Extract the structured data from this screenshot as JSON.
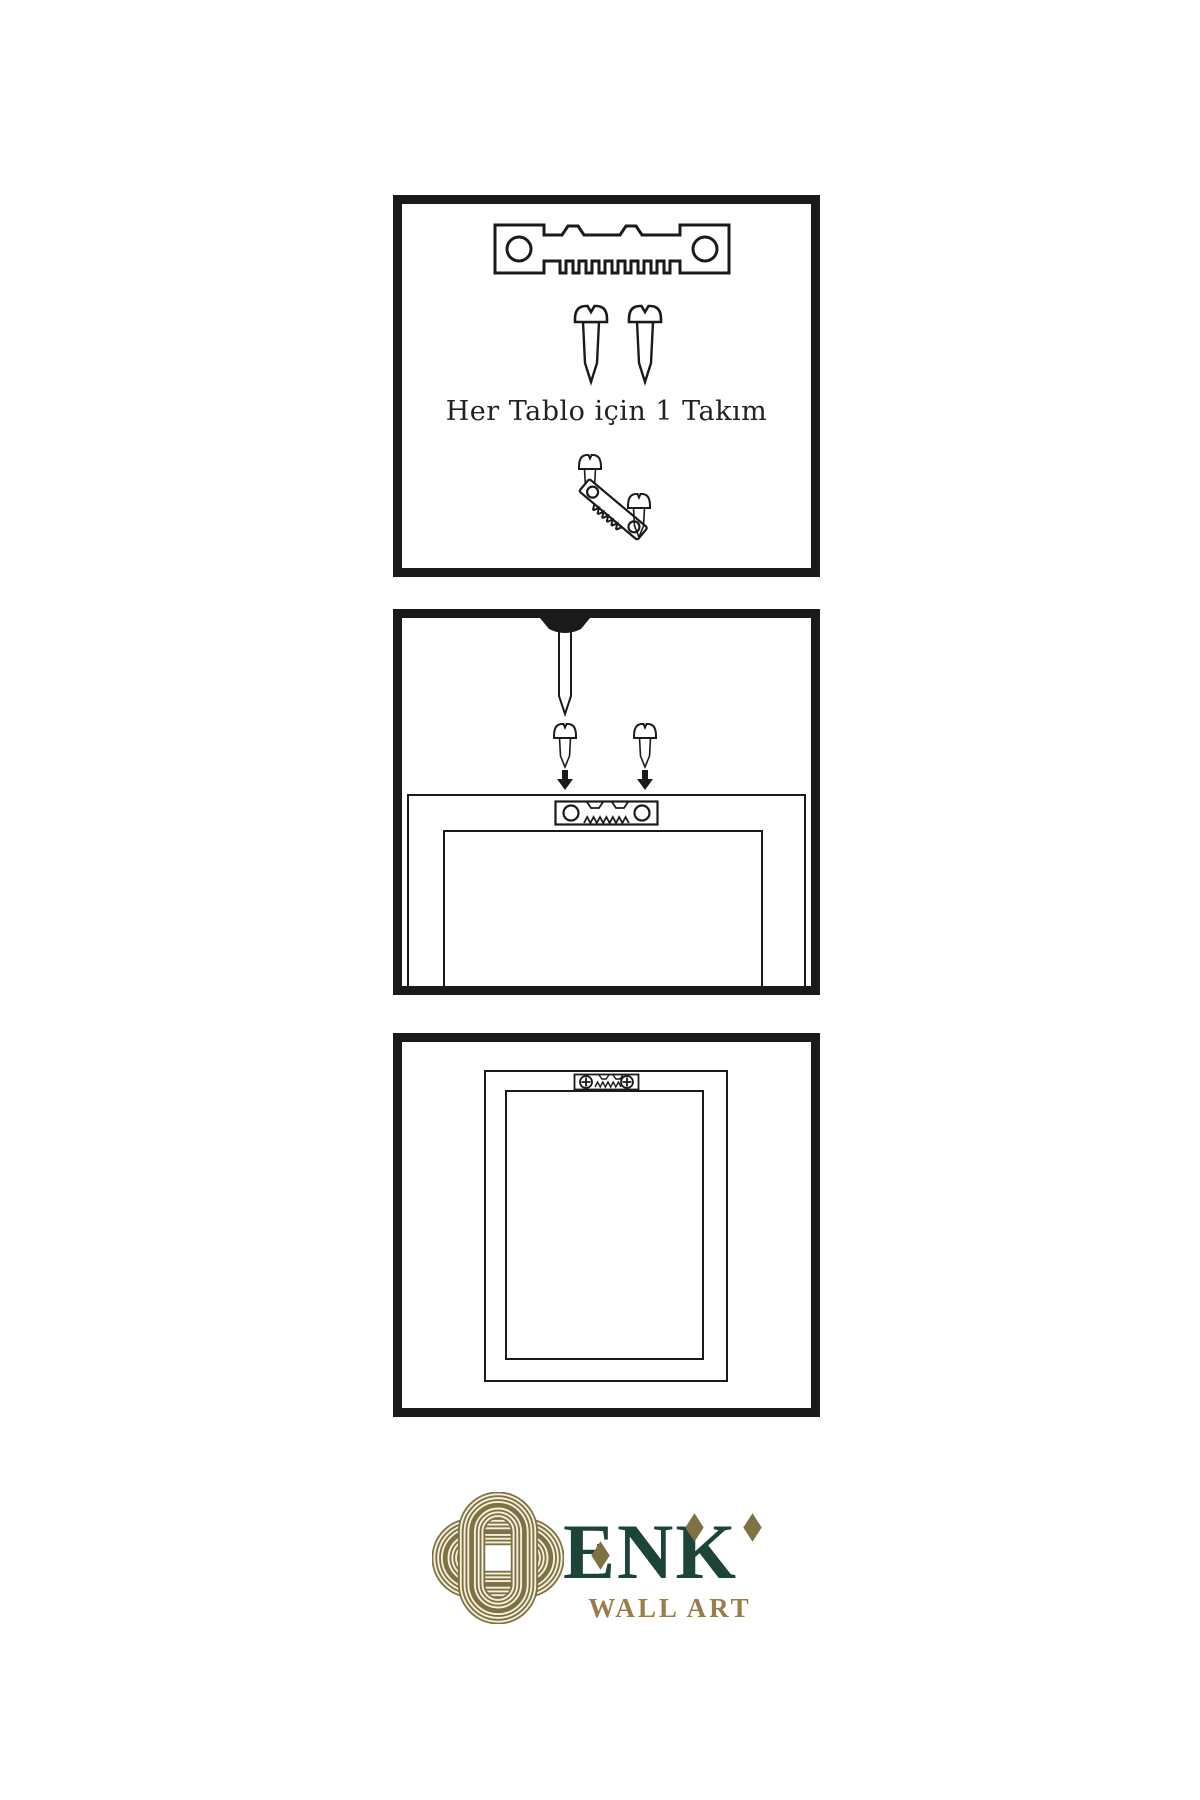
{
  "colors": {
    "line": "#1a1a1a",
    "screw_dark": "#2e2e2e",
    "logo_gold": "#7e7245",
    "logo_green": "#1c4438",
    "logo_text_gold": "#9a7e49",
    "logo_cream": "#f6f1de",
    "background": "#ffffff"
  },
  "panels": {
    "hardware_kit": {
      "caption": "Her Tablo için 1 Takım"
    },
    "wall_installation": {},
    "hanging_frame": {}
  },
  "logo": {
    "brand": "ENK",
    "tagline": "WALL ART"
  },
  "icons": {
    "sawtooth_hanger": "metal sawtooth picture hanger bar with two screw holes",
    "screw": "threaded wood screw, side view",
    "nail": "nail driven through wall, point down",
    "arrow_down": "solid downward arrow",
    "phillips_screw_head": "circle with cross screw head",
    "knot_logo": "interlaced gold line knot emblem"
  }
}
